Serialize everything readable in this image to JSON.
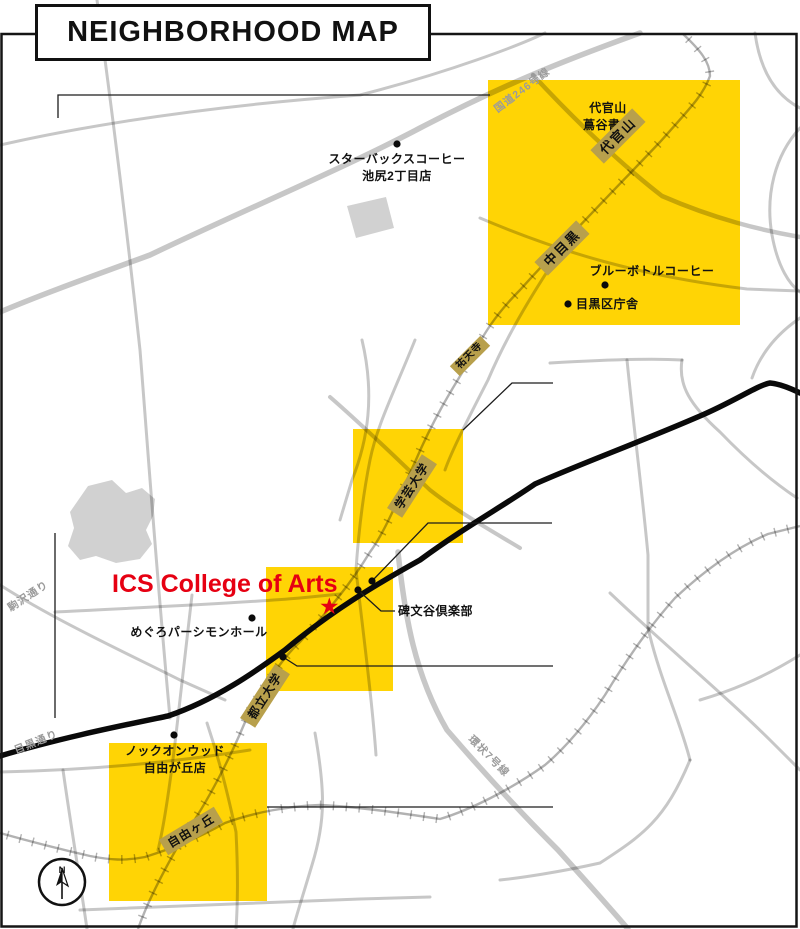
{
  "title": "NEIGHBORHOOD MAP",
  "colors": {
    "highlight": "#FFD405",
    "badge": "#B8A04C",
    "red": "#E60012"
  },
  "stations": {
    "daikanyama": "代官山",
    "nakameguro": "中目黒",
    "yutenji": "祐天寺",
    "gakugeidaigaku": "学芸大学",
    "toritsudaigaku": "都立大学",
    "jiyugaoka": "自由ヶ丘"
  },
  "roads": {
    "route246": "国道246号線",
    "komazawa_dori": "駒沢通り",
    "meguro_dori": "目黒通り",
    "kanjo7": "環状7号線"
  },
  "pois": {
    "starbucks": {
      "line1": "スターバックスコーヒー",
      "line2": "池尻2丁目店"
    },
    "daikanyama_tsutaya": {
      "line1": "代官山",
      "line2": "蔦谷書店"
    },
    "bluebottle": {
      "label": "ブルーボトルコーヒー"
    },
    "meguro_ward_office": {
      "label": "目黒区庁舎"
    },
    "persimmon_hall": {
      "label": "めぐろパーシモンホール"
    },
    "himonya_club": {
      "label": "碑文谷倶楽部"
    },
    "knock_on_wood": {
      "line1": "ノックオンウッド",
      "line2": "自由が丘店"
    }
  },
  "main_poi": {
    "label": "ICS College of Arts",
    "marker": "★"
  },
  "compass": {
    "label": "N"
  }
}
